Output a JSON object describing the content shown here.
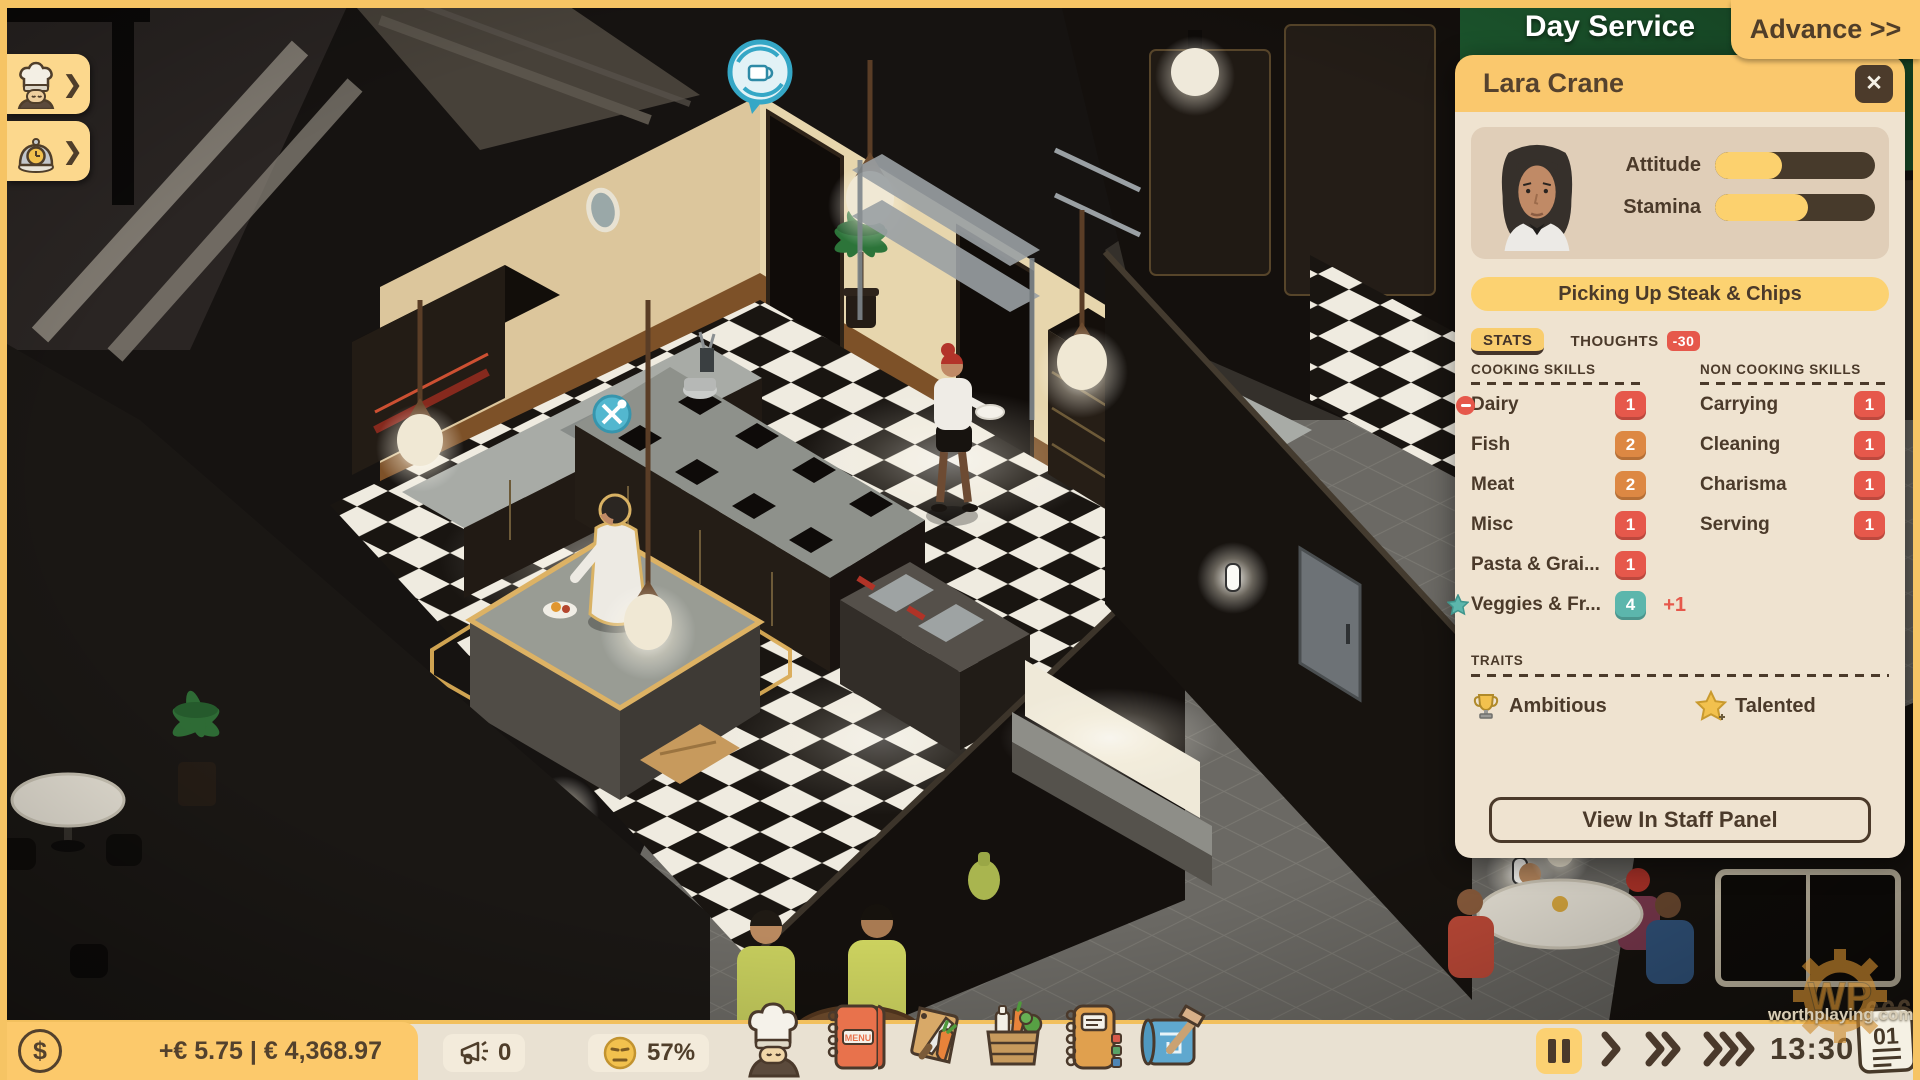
{
  "hud": {
    "phase_label": "Day Service",
    "advance_button_label": "Advance >>"
  },
  "left_quick_tabs": [
    {
      "id": "staff",
      "chevron": "❯"
    },
    {
      "id": "service",
      "chevron": "❯"
    }
  ],
  "staff_panel": {
    "title": "Lara Crane",
    "close_glyph": "✕",
    "meters": [
      {
        "label": "Attitude",
        "percent": "42%"
      },
      {
        "label": "Stamina",
        "percent": "58%"
      }
    ],
    "current_action": "Picking Up Steak & Chips",
    "tabs": {
      "stats": "STATS",
      "thoughts": "THOUGHTS",
      "thoughts_badge": "-30"
    },
    "cooking_skills": {
      "header": "COOKING SKILLS",
      "rows": [
        {
          "label": "Dairy",
          "value": "1",
          "badge_color": "#e6584b",
          "decreasing": true
        },
        {
          "label": "Fish",
          "value": "2",
          "badge_color": "#dd8843"
        },
        {
          "label": "Meat",
          "value": "2",
          "badge_color": "#dd8843"
        },
        {
          "label": "Misc",
          "value": "1",
          "badge_color": "#e6584b"
        },
        {
          "label": "Pasta & Grai...",
          "value": "1",
          "badge_color": "#e6584b"
        },
        {
          "label": "Veggies & Fr...",
          "value": "4",
          "badge_color": "#5cb6ac",
          "starred": true,
          "delta": "+1"
        }
      ]
    },
    "non_cooking_skills": {
      "header": "NON COOKING SKILLS",
      "rows": [
        {
          "label": "Carrying",
          "value": "1",
          "badge_color": "#e6584b"
        },
        {
          "label": "Cleaning",
          "value": "1",
          "badge_color": "#e6584b"
        },
        {
          "label": "Charisma",
          "value": "1",
          "badge_color": "#e6584b"
        },
        {
          "label": "Serving",
          "value": "1",
          "badge_color": "#e6584b"
        }
      ]
    },
    "traits": {
      "header": "TRAITS",
      "items": [
        {
          "label": "Ambitious",
          "icon": "trophy-icon"
        },
        {
          "label": "Talented",
          "icon": "star-plus-icon"
        }
      ]
    },
    "view_button_label": "View In Staff Panel"
  },
  "bottom_bar": {
    "money_text": "+€ 5.75 | € 4,368.97",
    "currency_glyph": "$",
    "marketing_count": "0",
    "satisfaction_percent": "57%",
    "time": "13:30",
    "calendar_day": "01",
    "menu_icon_text": "MENU"
  },
  "watermark": {
    "logo": "WP",
    "site": "worthplaying.com"
  },
  "colors": {
    "accent_yellow": "#fcc96d",
    "panel_cream": "#efe3d0",
    "card_tan": "#e0ceb8",
    "dark_brown": "#4b3a2a",
    "red_badge": "#e6584b",
    "orange_badge": "#dd8843",
    "teal_badge": "#5cb6ac"
  }
}
